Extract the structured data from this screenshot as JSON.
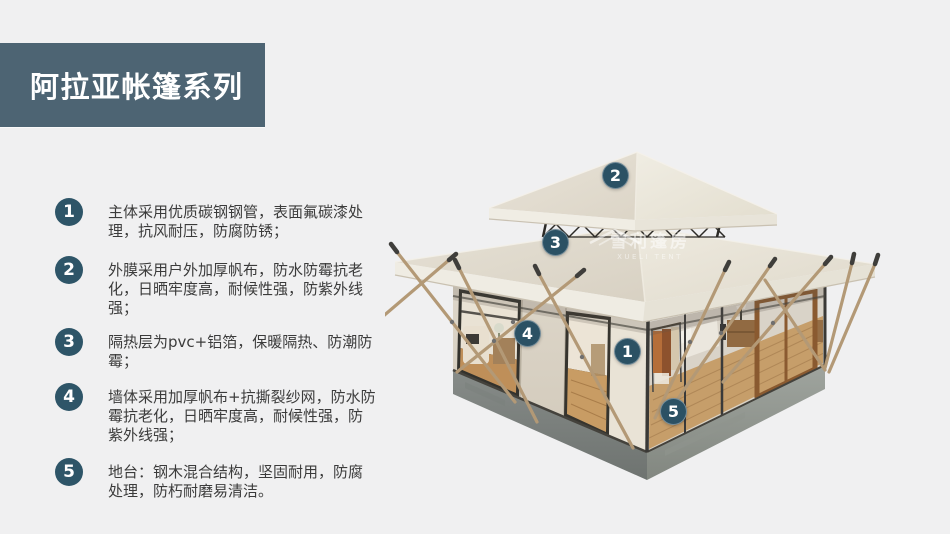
{
  "banner": {
    "title": "阿拉亚帐篷系列"
  },
  "features": [
    {
      "num": "1",
      "text": "主体采用优质碳钢钢管，表面氟碳漆处理，抗风耐压，防腐防锈；"
    },
    {
      "num": "2",
      "text": "外膜采用户外加厚帆布，防水防霉抗老化，日晒牢度高，耐候性强，防紫外线强；"
    },
    {
      "num": "3",
      "text": "隔热层为pvc+铝箔，保暖隔热、防潮防霉；"
    },
    {
      "num": "4",
      "text": "墙体采用加厚帆布+抗撕裂纱网，防水防霉抗老化，日晒牢度高，耐候性强，防紫外线强；"
    },
    {
      "num": "5",
      "text": "地台：钢木混合结构，坚固耐用，防腐处理，防朽耐磨易清洁。"
    }
  ],
  "diagram": {
    "callouts": [
      {
        "num": "1"
      },
      {
        "num": "2"
      },
      {
        "num": "3"
      },
      {
        "num": "4"
      },
      {
        "num": "5"
      }
    ],
    "watermark": {
      "cn": "雪利篷房",
      "en": "XUELI TENT"
    }
  },
  "colors": {
    "background": "#f0f0f1",
    "banner_bg": "#4d6473",
    "badge_bg": "#2e5568",
    "callout_bg": "#2b5164",
    "body_text": "#3b3b3b",
    "roof_canvas": "#e7e2d6",
    "platform_gray": "#8d928e",
    "pole_wood": "#b39976",
    "interior_wood": "#c49861"
  }
}
